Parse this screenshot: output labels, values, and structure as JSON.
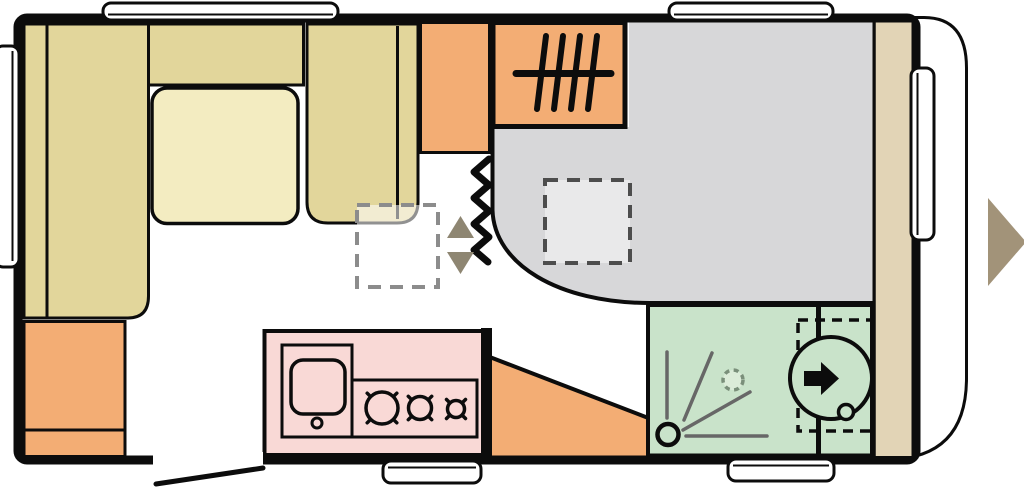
{
  "figure": {
    "kind": "caravan-floor-plan",
    "orientation": "side-view-top-down, front (panoramic window) at left, rounded rear at right"
  },
  "colors": {
    "outline": "#0c0c0c",
    "sofa": "#e2d69b",
    "table": "#f3ecc1",
    "cabinet": "#f3ad74",
    "kitchen": "#f9d9d6",
    "bathroom": "#c9e3ca",
    "bed": "#d7d7d9",
    "bed_highlight": "#e9e9ea",
    "panel": "#e2d4b6",
    "entry_arrow": "#a29379",
    "step_arrow": "#8e8672",
    "shower_lines": "#676767",
    "dashed_dark": "#4d4d4d",
    "dashed_light": "#8c8c8c",
    "drain_fill": "#dcecd9",
    "drain_stroke": "#7a8f7a",
    "ghost": "rgba(255,255,255,0.55)",
    "window": "#ffffff"
  },
  "icons": {
    "heater": "tally-hatch-marks",
    "partition": "vertical-zigzag-line",
    "entry_steps": "up-down-triangles",
    "entry_door": "large-right-arrow",
    "toilet_swivel": "right-arrow-in-circle",
    "shower": "corner-circle-with-spray-lines",
    "hob": "three-circled-cross-burners"
  }
}
